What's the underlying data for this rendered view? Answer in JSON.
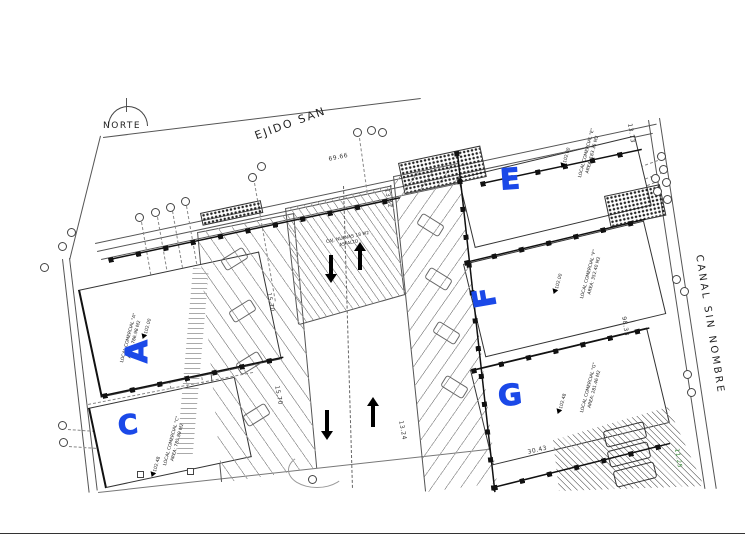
{
  "labels": {
    "north": "NORTE",
    "street_top": "EJIDO SAN",
    "street_right": "CANAL SIN NOMBRE"
  },
  "plaza": {
    "line1": "CAJ. NUEVAS 18 M2",
    "line2": "ASFALTO"
  },
  "buildings": [
    {
      "marker": "A",
      "name": "LOCAL COMERCIAL \"A\"",
      "area": "AREA: 786.98 M2",
      "level": "+102.00"
    },
    {
      "marker": "C",
      "name": "LOCAL COMERCIAL \"C\"",
      "area": "AREA: 785.89 M2",
      "level": "+102.48"
    },
    {
      "marker": "E",
      "name": "LOCAL COMERCIAL \"E\"",
      "area": "AREA: 183.35 M2",
      "level": "+102.00"
    },
    {
      "marker": "F",
      "name": "LOCAL COMERCIAL \"F\"",
      "area": "AREA: 352.40 M2",
      "level": "+102.00"
    },
    {
      "marker": "G",
      "name": "LOCAL COMERCIAL \"G\"",
      "area": "AREA: 281.46 M2",
      "level": "+102.48"
    }
  ],
  "dimensions": {
    "street_top": "69.66",
    "canal": "98.33",
    "canal_corner": "13.73",
    "aisle_left_upper": "15.70",
    "aisle_left_lower": "15.70",
    "aisle_right_upper": "13.42",
    "aisle_right_lower": "13.24",
    "building_g_front": "30.43",
    "parking_depth": "11.25"
  },
  "colors": {
    "marker_blue": "#1b49e8",
    "dimension_green": "#3a8a3a",
    "line": "#555555"
  }
}
